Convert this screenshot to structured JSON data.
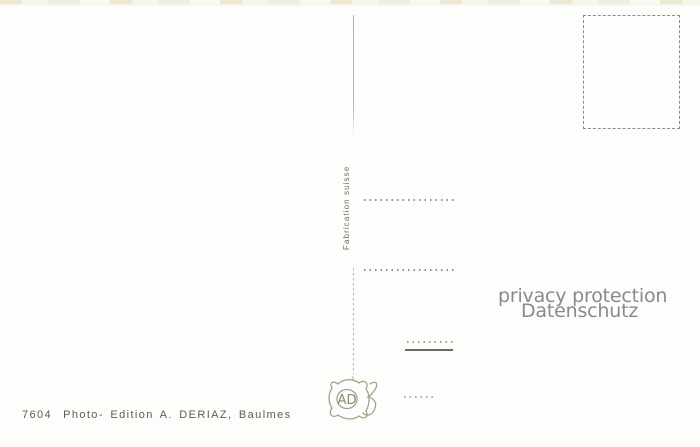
{
  "postcard": {
    "imprint_number": "7604",
    "imprint_publisher": "Photo- Edition A. DERIAZ, Baulmes",
    "fabrication_label": "Fabrication suisse",
    "monogram_letters": "AD",
    "watermark_line1": "privacy protection",
    "watermark_line2": "Datenschutz",
    "colors": {
      "paper": "#fdfdfc",
      "paper_edge_cream": "#e9e4cb",
      "line_gray": "#8f8f88",
      "divider_gray": "#b6b6af",
      "imprint_ink": "#5d5d4d",
      "monogram_ink": "#a8a189",
      "solid_line_ink": "#6a6a5c",
      "watermark_gray": "#8a8a8a"
    }
  }
}
